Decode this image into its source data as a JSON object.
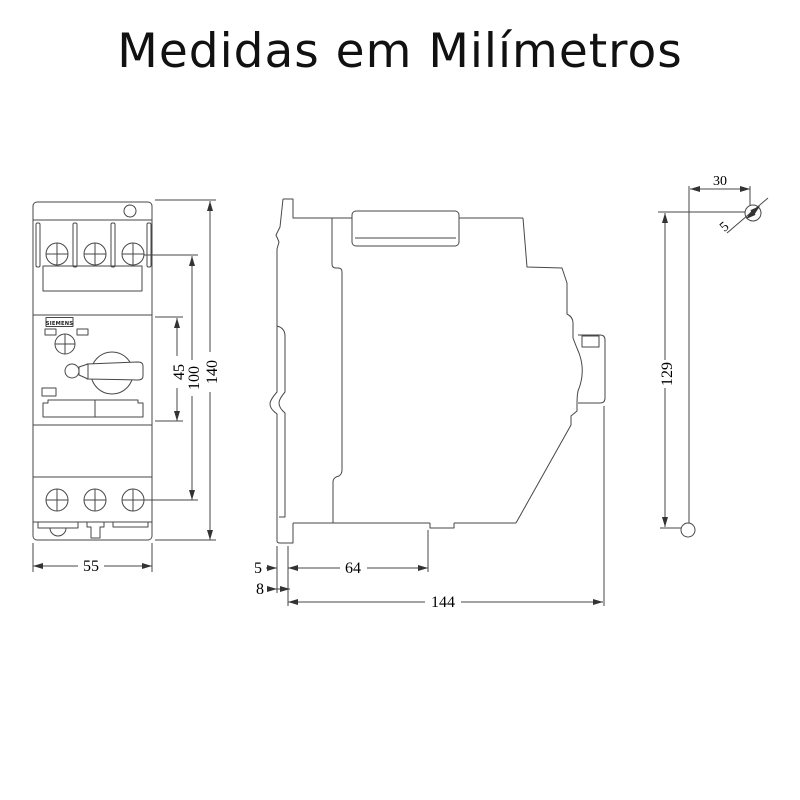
{
  "title": "Medidas em Milímetros",
  "brand_label": "SIEMENS",
  "front_view": {
    "width": "55",
    "face_height": "45",
    "screw_spacing": "100",
    "total_height": "140"
  },
  "side_view": {
    "clip_offset": "5",
    "clip_depth": "8",
    "base_depth": "64",
    "total_depth": "144"
  },
  "mounting_view": {
    "horizontal_offset": "30",
    "screw_diameter": "5",
    "vertical_spacing": "129"
  },
  "colors": {
    "line": "#474747",
    "text": "#000000",
    "background": "#ffffff"
  }
}
